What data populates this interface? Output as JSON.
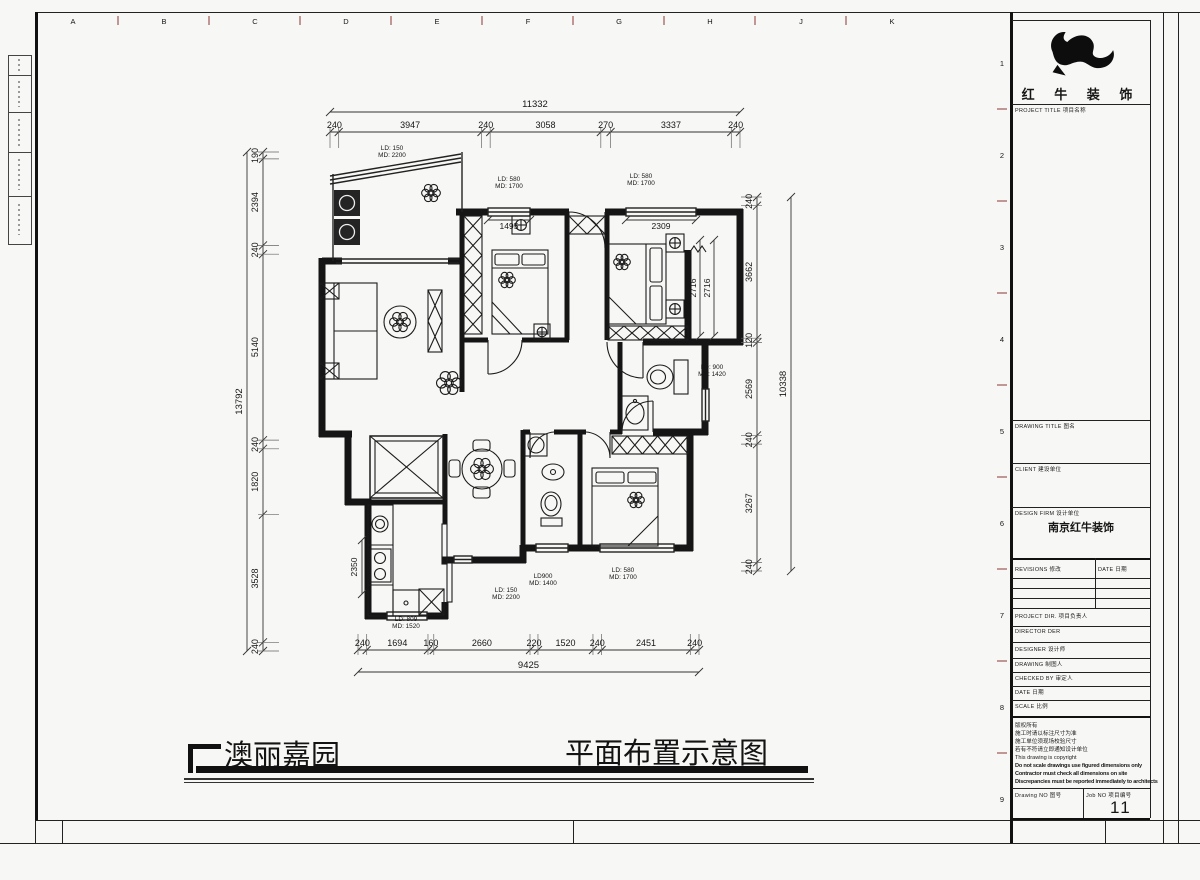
{
  "sheet": {
    "grid_letters_top": [
      "A",
      "B",
      "C",
      "D",
      "E",
      "F",
      "G",
      "H",
      "J",
      "K"
    ],
    "grid_numbers_right": [
      "1",
      "2",
      "3",
      "4",
      "5",
      "6",
      "7",
      "8",
      "9"
    ]
  },
  "titleblock": {
    "company_name": "红 牛 装 饰",
    "fields": {
      "project_title": "PROJECT TITLE  项目名称",
      "drawing_title": "DRAWING TITLE  图名",
      "client": "CLIENT  建设单位",
      "design_firm": "DESIGN FIRM  设计单位",
      "design_firm_value": "南京红牛装饰",
      "revisions": "REVISIONS  修改",
      "revision_date_col": "DATE  日期",
      "project_dir": "PROJECT DIR.  项目负责人",
      "director": "DIRECTOR DER",
      "designer": "DESIGNER  设计师",
      "drawing": "DRAWING  制图人",
      "checked_by": "CHECKED BY  审定人",
      "date": "DATE  日期",
      "scale": "SCALE  比例",
      "drawing_no": "Drawing NO  图号",
      "job_no": "Job NO  项目编号",
      "job_no_value": "11"
    },
    "notes": [
      "版权所有",
      "施工时请以标注尺寸为准",
      "施工单位须现场校验尺寸",
      "若有不符请立即通知设计单位",
      "This drawing is copyright",
      "Do not scale drawings use figured dimensions only",
      "Contractor must check all dimensions on site",
      "Discrepancies must be reported immediately to architects"
    ]
  },
  "footer": {
    "project_name": "澳丽嘉园",
    "drawing_name": "平面布置示意图"
  },
  "plan": {
    "dim_chains": {
      "top": {
        "total": "11332",
        "segments": [
          "240",
          "3947",
          "240",
          "3058",
          "270",
          "3337",
          "240"
        ]
      },
      "left": {
        "total": "13792",
        "segments": [
          "190",
          "2394",
          "240",
          "5140",
          "240",
          "1820",
          "3528",
          "240"
        ]
      },
      "right": {
        "total": "10338",
        "segments": [
          "240",
          "3662",
          "120",
          "2569",
          "240",
          "3267",
          "240"
        ]
      },
      "bottom": {
        "total": "9425",
        "segments": [
          "240",
          "1694",
          "160",
          "2660",
          "220",
          "1520",
          "240",
          "2451",
          "240"
        ]
      }
    },
    "aux_dims": [
      {
        "text": "1495",
        "x1": 488,
        "y1": 220,
        "x2": 530,
        "y2": 220,
        "tx": 509,
        "ty": 229,
        "rot": 0
      },
      {
        "text": "2309",
        "x1": 626,
        "y1": 220,
        "x2": 696,
        "y2": 220,
        "tx": 661,
        "ty": 229,
        "rot": 0
      },
      {
        "text": "2716",
        "x1": 700,
        "y1": 240,
        "x2": 700,
        "y2": 336,
        "tx": 696,
        "ty": 288,
        "rot": -90
      },
      {
        "text": "2716",
        "x1": 714,
        "y1": 240,
        "x2": 714,
        "y2": 336,
        "tx": 710,
        "ty": 288,
        "rot": -90
      },
      {
        "text": "2350",
        "x1": 362,
        "y1": 540,
        "x2": 362,
        "y2": 594,
        "tx": 357,
        "ty": 567,
        "rot": -90
      }
    ],
    "labels": [
      {
        "text": "LD: 150\nMD: 2200",
        "x": 392,
        "y": 150
      },
      {
        "text": "LD: 580\nMD: 1700",
        "x": 509,
        "y": 181
      },
      {
        "text": "LD: 580\nMD: 1700",
        "x": 641,
        "y": 178
      },
      {
        "text": "LD: 900\nMD: 1420",
        "x": 712,
        "y": 369
      },
      {
        "text": "LD900\nMD: 1400",
        "x": 543,
        "y": 578
      },
      {
        "text": "LD: 580\nMD: 1700",
        "x": 623,
        "y": 572
      },
      {
        "text": "LD: 150\nMD: 2200",
        "x": 506,
        "y": 592
      },
      {
        "text": "LD: 809\nMD: 1520",
        "x": 406,
        "y": 621
      }
    ]
  }
}
